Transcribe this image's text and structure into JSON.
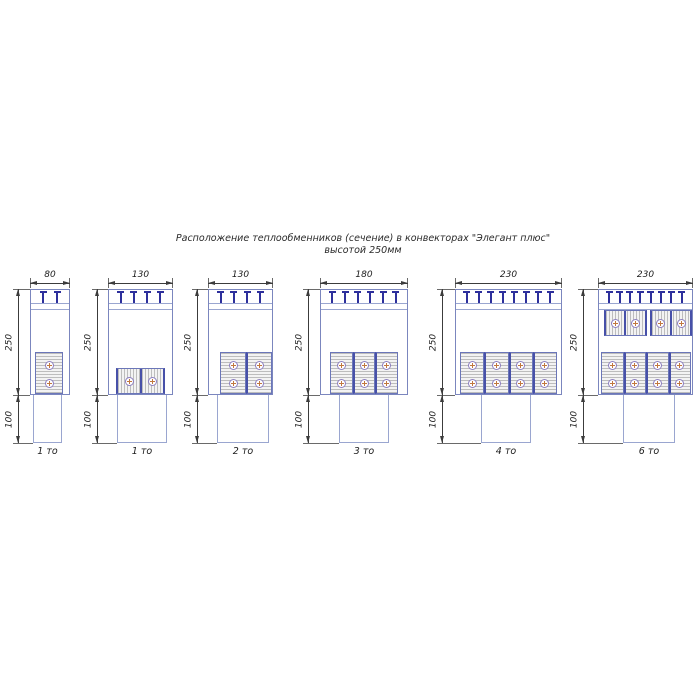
{
  "title": {
    "line1": "Расположение теплообменников (сечение) в конвекторах \"Элегант плюс\"",
    "line2": "высотой 250мм"
  },
  "colors": {
    "outline_blue": "#7b86be",
    "light_blue": "#9aa6d0",
    "navy_bracket": "#2d2f9c",
    "hx_border": "#6b76b8",
    "hx_divider": "#4750a8",
    "fin_gray": "#bdbdbd",
    "fin_bg": "#f3f3f3",
    "tube_ring": "#8d7fc0",
    "tube_cross": "#c1773f",
    "dim_line": "#3c3c3c",
    "dim_ext": "#6a6a6a",
    "text": "#1c1c1c"
  },
  "common": {
    "dim_line_y": 283,
    "body_top": 289,
    "grille_lines": [
      303,
      309
    ],
    "tee_top": 291,
    "body_bottom": 395,
    "pedestal_bottom": 443,
    "caption_y": 446
  },
  "diagrams": [
    {
      "caption": "1 то",
      "width_label": "80",
      "upper_height_label": "250",
      "lower_height_label": "100",
      "tee_count": 2,
      "geom": {
        "body_x": 30,
        "body_w": 40,
        "dim_x": 18,
        "ped_x": 33,
        "ped_w": 29,
        "groups": [
          {
            "orient": "v",
            "x": 35,
            "y": 352,
            "w": 28,
            "h": 42,
            "blocks": 1
          }
        ]
      }
    },
    {
      "caption": "1 то",
      "width_label": "130",
      "upper_height_label": "250",
      "lower_height_label": "100",
      "tee_count": 4,
      "geom": {
        "body_x": 108,
        "body_w": 65,
        "dim_x": 97,
        "ped_x": 117,
        "ped_w": 50,
        "groups": [
          {
            "orient": "h",
            "x": 116,
            "y": 368,
            "w": 49,
            "h": 26,
            "blocks": 1
          }
        ]
      }
    },
    {
      "caption": "2 то",
      "width_label": "130",
      "upper_height_label": "250",
      "lower_height_label": "100",
      "tee_count": 4,
      "geom": {
        "body_x": 208,
        "body_w": 65,
        "dim_x": 197,
        "ped_x": 217,
        "ped_w": 52,
        "groups": [
          {
            "orient": "v",
            "x": 220,
            "y": 352,
            "w": 52,
            "h": 42,
            "blocks": 2
          }
        ]
      }
    },
    {
      "caption": "3 то",
      "width_label": "180",
      "upper_height_label": "250",
      "lower_height_label": "100",
      "tee_count": 6,
      "geom": {
        "body_x": 320,
        "body_w": 88,
        "dim_x": 308,
        "ped_x": 339,
        "ped_w": 50,
        "groups": [
          {
            "orient": "v",
            "x": 330,
            "y": 352,
            "w": 68,
            "h": 42,
            "blocks": 3
          }
        ]
      }
    },
    {
      "caption": "4 то",
      "width_label": "230",
      "upper_height_label": "250",
      "lower_height_label": "100",
      "tee_count": 8,
      "geom": {
        "body_x": 455,
        "body_w": 107,
        "dim_x": 442,
        "ped_x": 481,
        "ped_w": 50,
        "groups": [
          {
            "orient": "v",
            "x": 460,
            "y": 352,
            "w": 97,
            "h": 42,
            "blocks": 4
          }
        ]
      }
    },
    {
      "caption": "6 то",
      "width_label": "230",
      "upper_height_label": "250",
      "lower_height_label": "100",
      "tee_count": 8,
      "geom": {
        "body_x": 598,
        "body_w": 95,
        "dim_x": 583,
        "ped_x": 623,
        "ped_w": 52,
        "groups": [
          {
            "orient": "h",
            "x": 604,
            "y": 310,
            "w": 88,
            "h": 26,
            "blocks": 2
          },
          {
            "orient": "v",
            "x": 601,
            "y": 352,
            "w": 90,
            "h": 42,
            "blocks": 4
          }
        ]
      }
    }
  ]
}
